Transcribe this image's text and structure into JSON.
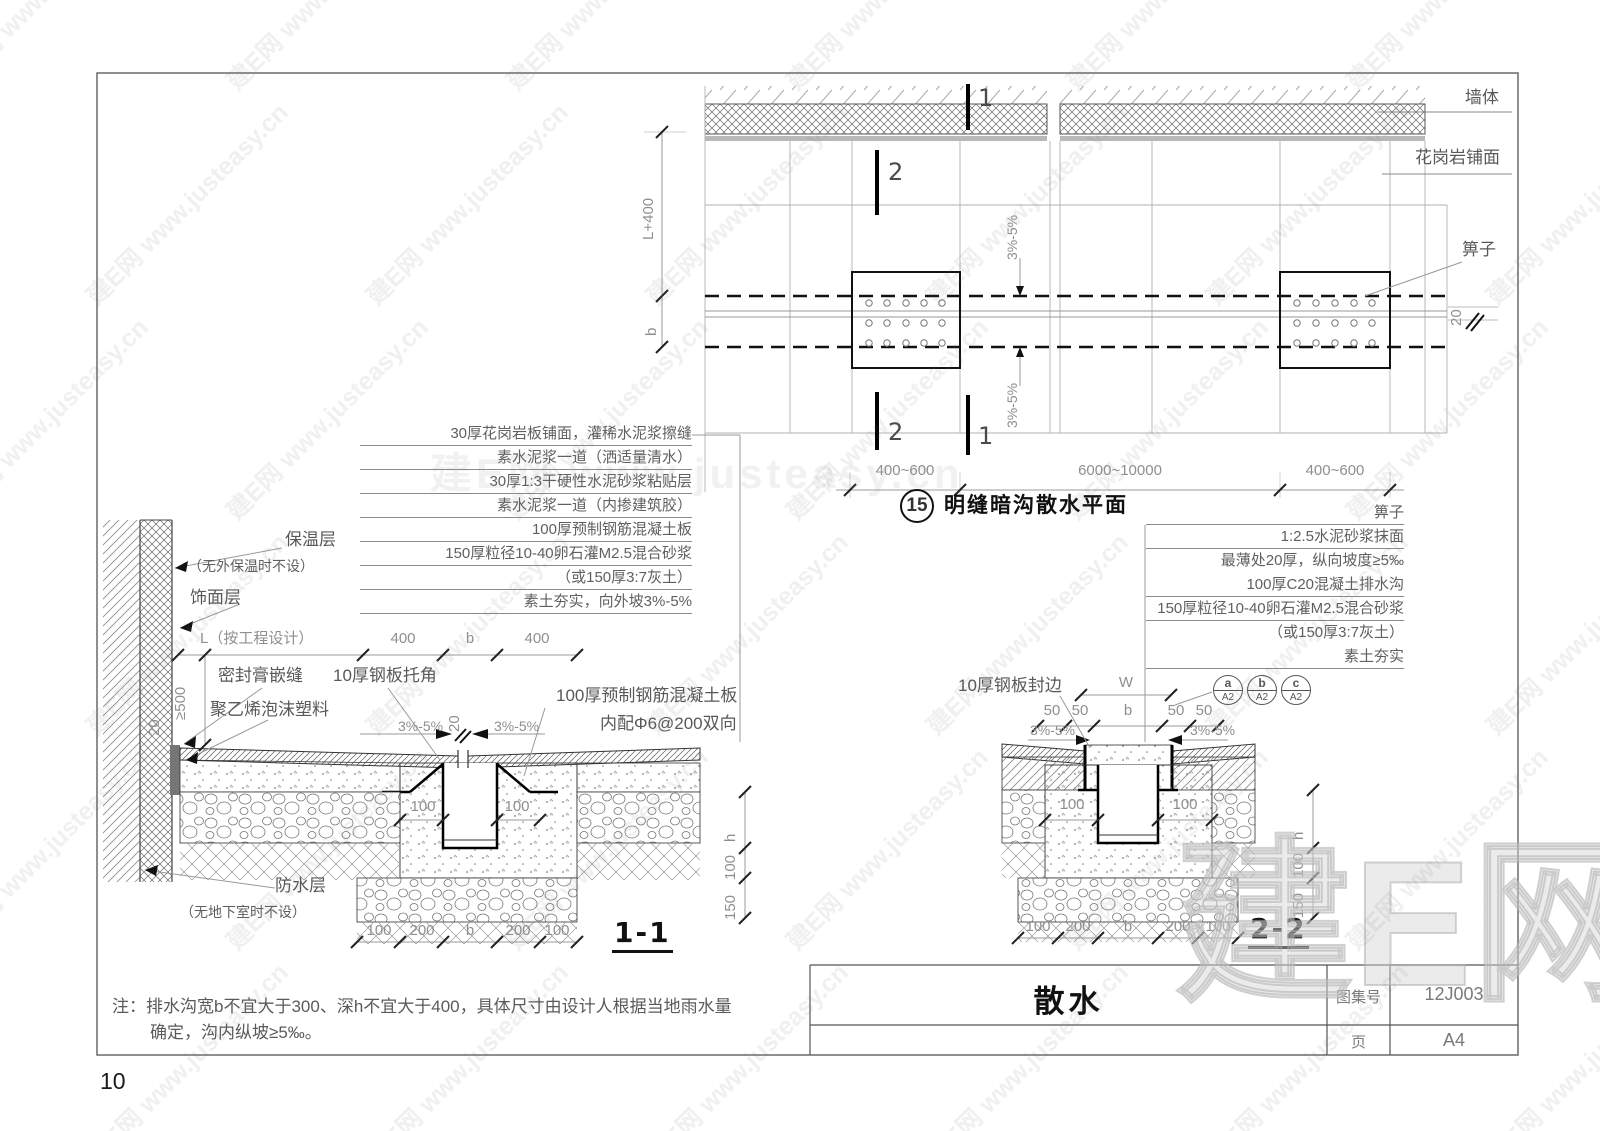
{
  "watermark": {
    "tile": "建E网 www.justeasy.cn",
    "center": "建E网 www.justeasy.cn",
    "big": "建E网"
  },
  "page": {
    "number": "10"
  },
  "plan": {
    "wall_label": "墙体",
    "paving_label": "花岗岩铺面",
    "grate_label": "箅子",
    "dim_20": "20",
    "dim_l400": "L+400",
    "dim_b": "b",
    "slope_upper": "3%-5%",
    "slope_lower": "3%-5%",
    "marker_1_top": "1",
    "marker_2_top": "2",
    "marker_2_bottom": "2",
    "marker_1_bottom": "1",
    "dims_bottom": [
      "400~600",
      "6000~10000",
      "400~600"
    ],
    "title_number": "15",
    "title": "明缝暗沟散水平面"
  },
  "s1": {
    "notes": [
      "30厚花岗岩板铺面，灌稀水泥浆擦缝",
      "素水泥浆一道（洒适量清水）",
      "30厚1:3干硬性水泥砂浆粘贴层",
      "素水泥浆一道（内掺建筑胶）",
      "100厚预制钢筋混凝土板",
      "150厚粒径10-40卵石灌M2.5混合砂浆",
      "（或150厚3:7灰土）",
      "素土夯实，向外坡3%-5%"
    ],
    "insulation": "保温层",
    "insulation_note": "（无外保温时不设）",
    "finish": "饰面层",
    "dim_l": "L（按工程设计）",
    "dim_400a": "400",
    "dim_b": "b",
    "dim_400b": "400",
    "dim_ge500": "≥500",
    "dim_20_wall": "20",
    "sealant": "密封膏嵌缝",
    "steel_angle": "10厚钢板托角",
    "foam": "聚乙烯泡沫塑料",
    "dim_20_gap": "20",
    "slope_left": "3%-5%",
    "slope_right": "3%-5%",
    "dim_100_left": "100",
    "dim_100_right": "100",
    "slab_label1": "100厚预制钢筋混凝土板",
    "slab_label2": "内配Φ6@200双向",
    "dim_h": "h",
    "dim_100v": "100",
    "dim_150v": "150",
    "waterproof": "防水层",
    "waterproof_note": "（无地下室时不设）",
    "dims_bottom": [
      "100",
      "200",
      "b",
      "200",
      "100"
    ],
    "title": "1-1"
  },
  "s2": {
    "grate": "箅子",
    "notes": [
      "1:2.5水泥砂浆抹面",
      "最薄处20厚，纵向坡度≥5‰",
      "100厚C20混凝土排水沟",
      "150厚粒径10-40卵石灌M2.5混合砂浆",
      "（或150厚3:7灰土）",
      "素土夯实"
    ],
    "steel_edge": "10厚钢板封边",
    "dim_w": "W",
    "dims_top": [
      "50",
      "50",
      "b",
      "50",
      "50"
    ],
    "bubbles": [
      {
        "top": "a",
        "bottom": "A2"
      },
      {
        "top": "b",
        "bottom": "A2"
      },
      {
        "top": "c",
        "bottom": "A2"
      }
    ],
    "slope_left": "3%-5%",
    "slope_right": "3%-5%",
    "dim_100_left": "100",
    "dim_100_right": "100",
    "dim_h": "h",
    "dim_100v": "100",
    "dim_150v": "150",
    "dims_bottom": [
      "100",
      "200",
      "b",
      "200",
      "100"
    ],
    "title": "2-2"
  },
  "note": {
    "line1": "注：排水沟宽b不宜大于300、深h不宜大于400，具体尺寸由设计人根据当地雨水量",
    "line2": "确定，沟内纵坡≥5‰。"
  },
  "titleblock": {
    "title": "散水",
    "atlas_label": "图集号",
    "atlas_number": "12J003",
    "page_label": "页",
    "page_value": "A4"
  }
}
